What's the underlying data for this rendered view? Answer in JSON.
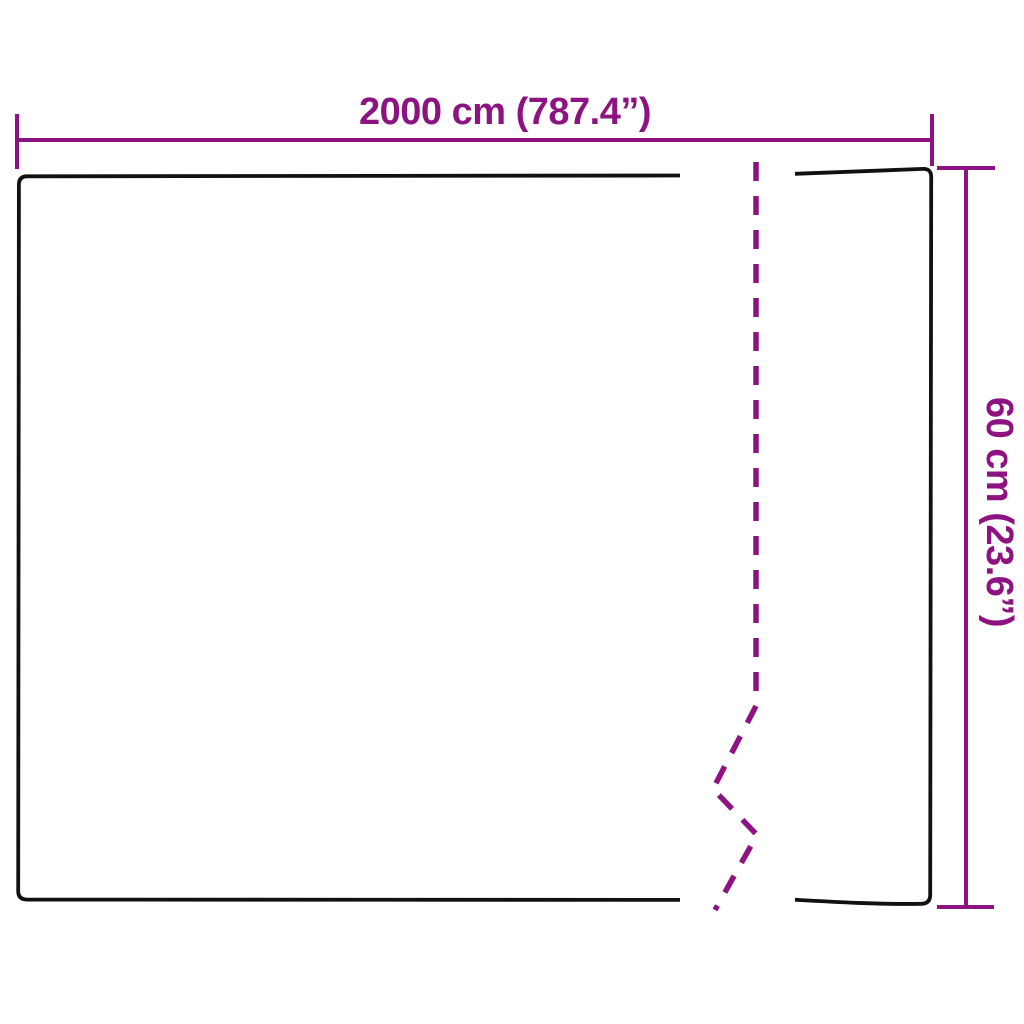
{
  "diagram": {
    "type": "product-dimension-diagram",
    "shape": "rectangle-outline-with-break-mark",
    "dimensions": {
      "width": {
        "value_cm": "2000",
        "unit_cm": "cm",
        "value_in": "787.4",
        "unit_in": "″",
        "label": "2000 cm (787.4”)"
      },
      "height": {
        "value_cm": "60",
        "unit_cm": "cm",
        "value_in": "23.6",
        "unit_in": "″",
        "label": "60 cm (23.6”)"
      }
    },
    "marks": {
      "break_line": "dashed-zigzag-break-icon",
      "dimension_end_caps": "tick"
    }
  },
  "colors": {
    "accent": "#8e1382",
    "outline": "#111111",
    "background": "#ffffff"
  }
}
